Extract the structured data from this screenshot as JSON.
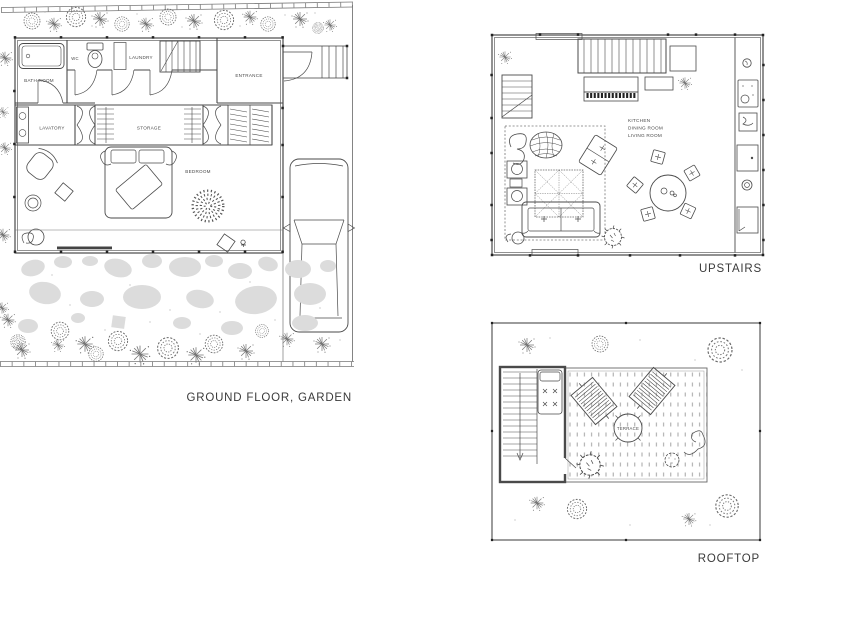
{
  "sheet": {
    "title": "house floor plans"
  },
  "plans": {
    "ground_floor": {
      "caption": "GROUND FLOOR, GARDEN",
      "rooms": {
        "bath_room": "BATH ROOM",
        "wc": "WC",
        "laundry": "LAUNDRY",
        "entrance": "ENTRANCE",
        "lavatory": "LAVATORY",
        "storage": "STORAGE",
        "bedroom": "BEDROOM"
      }
    },
    "upstairs": {
      "caption": "UPSTAIRS",
      "rooms": {
        "kitchen": "KITCHEN",
        "dining_room": "DINING ROOM",
        "living_room": "LIVING ROOM"
      }
    },
    "rooftop": {
      "caption": "ROOFTOP",
      "rooms": {
        "terrace": "TERRACE"
      }
    }
  },
  "colors": {
    "line": "#4a4a4a",
    "stone": "#dcdcdc",
    "text": "#3a3a3a",
    "background": "#ffffff"
  }
}
